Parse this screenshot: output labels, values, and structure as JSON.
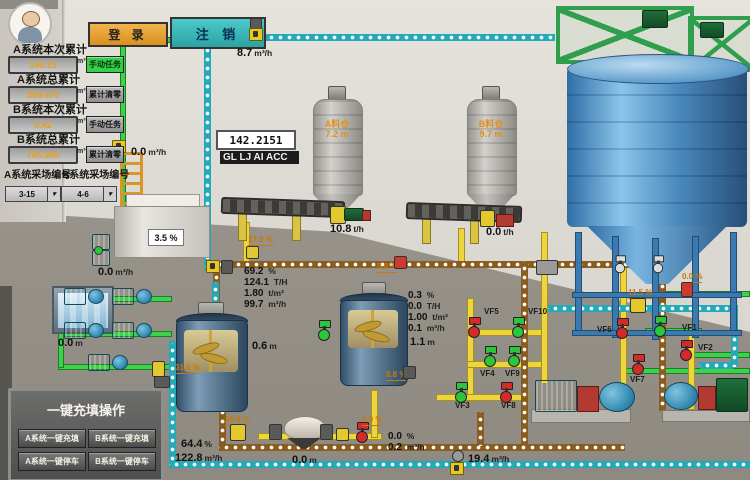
{
  "topbar": {
    "login_label": "登 录",
    "logout_label": "注 销"
  },
  "left_panel": {
    "fields": [
      {
        "label": "A系统本次累计",
        "value": "146.15",
        "unit": "m³",
        "action": "手动任务"
      },
      {
        "label": "A系统总累计",
        "value": "808.470",
        "unit": "m³",
        "action": "累计清零"
      },
      {
        "label": "B系统本次累计",
        "value": "0.42",
        "unit": "m³",
        "action": "手动任务"
      },
      {
        "label": "B系统总累计",
        "value": "765.280",
        "unit": "m³",
        "action": "累计清零"
      }
    ],
    "selectors": [
      {
        "label": "A系统采场编号",
        "value": "3-15"
      },
      {
        "label": "B系统采场编号",
        "value": "4-6"
      }
    ]
  },
  "onekey_panel": {
    "title": "一键充填操作",
    "buttons": [
      {
        "label": "A系统一键充填"
      },
      {
        "label": "B系统一键充填"
      },
      {
        "label": "A系统一键停车"
      },
      {
        "label": "B系统一键停车"
      }
    ]
  },
  "displays": {
    "flow_top": {
      "v": "8.7",
      "u": "m³/h"
    },
    "totalizer": {
      "v": "142.2151"
    },
    "marquee": {
      "text": "GL LJ AI ACC"
    },
    "silo_a": {
      "name": "A料仓",
      "v": "7.2",
      "u": "m"
    },
    "silo_b": {
      "name": "B料仓",
      "v": "9.7",
      "u": "m"
    },
    "conveyor_a": {
      "v": "10.8",
      "u": "t/h"
    },
    "conveyor_b": {
      "v": "0.0",
      "u": "t/h"
    },
    "tank_concentration": {
      "v": "3.5",
      "u": "%"
    },
    "flow_station": {
      "v": "0.0",
      "u": "m³/h"
    },
    "flow_line_left": {
      "v": "0.0",
      "u": "m³/h"
    },
    "water_tank": {
      "v": "0.0",
      "u": "m"
    },
    "line_a": [
      {
        "v": "69.2",
        "u": "%"
      },
      {
        "v": "124.1",
        "u": "T/H"
      },
      {
        "v": "1.80",
        "u": "t/m³"
      },
      {
        "v": "99.7",
        "u": "m³/h"
      }
    ],
    "line_b": [
      {
        "v": "0.3",
        "u": "%"
      },
      {
        "v": "0.0",
        "u": "T/H"
      },
      {
        "v": "1.00",
        "u": "t/m³"
      },
      {
        "v": "0.1",
        "u": "m³/h"
      }
    ],
    "mixer_a": {
      "v": "0.6",
      "u": "m"
    },
    "mixer_b": {
      "v": "1.1",
      "u": "m"
    },
    "underflow_concentration": {
      "v": "64.4",
      "u": "%"
    },
    "underflow_flow": {
      "v": "122.8",
      "u": "m³/h"
    },
    "hopper": {
      "v": "0.0",
      "u": "m"
    },
    "line_c": [
      {
        "v": "0.0",
        "u": "%"
      },
      {
        "v": "0.2",
        "u": "m³/h"
      }
    ],
    "flow_return": {
      "v": "19.4",
      "u": "m³/h"
    }
  },
  "valves": [
    {
      "name": "VF5",
      "state": "closed"
    },
    {
      "name": "VF10",
      "state": "open"
    },
    {
      "name": "VF4",
      "state": "open"
    },
    {
      "name": "VF9",
      "state": "open"
    },
    {
      "name": "VF3",
      "state": "open"
    },
    {
      "name": "VF8",
      "state": "closed"
    },
    {
      "name": "VF6",
      "state": "closed"
    },
    {
      "name": "VF1",
      "state": "open"
    },
    {
      "name": "VF2",
      "state": "closed"
    },
    {
      "name": "VF7",
      "state": "closed"
    }
  ],
  "opening_labels": [
    {
      "text": "17.9 %"
    },
    {
      "text": "8.8 %"
    },
    {
      "text": "31.0 %"
    },
    {
      "text": "26.8 %"
    },
    {
      "text": "8.8 %"
    },
    {
      "text": "0.0 %"
    },
    {
      "text": "11.5 %"
    },
    {
      "text": "0.0 %"
    }
  ],
  "colors": {
    "pipe_cyan": "#23aab9",
    "pipe_brown": "#8a5c20",
    "pipe_yellow": "#ecd53f",
    "pipe_green": "#3fd14b",
    "valve_open": "#2cc63d",
    "valve_closed": "#d42a2a",
    "login_orange": "#e8a33d",
    "logout_teal": "#3fbfbf"
  }
}
